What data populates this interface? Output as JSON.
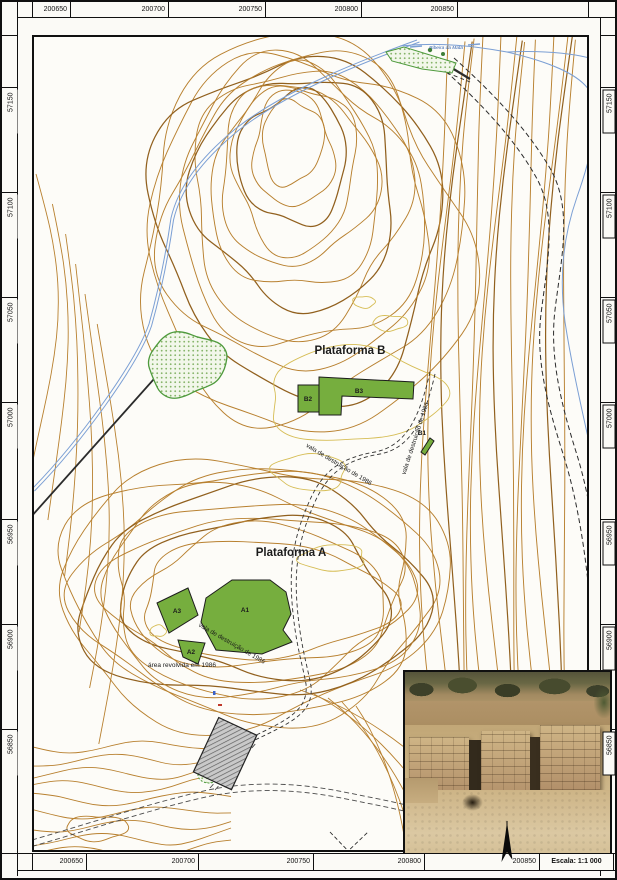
{
  "sheet": {
    "top_coords": [
      "200650",
      "200700",
      "200750",
      "200800",
      "200850"
    ],
    "bottom_coords": [
      "200650",
      "200700",
      "200750",
      "200800",
      "200850"
    ],
    "left_coords": [
      "57150",
      "57100",
      "57050",
      "57000",
      "56950",
      "56900",
      "56850"
    ],
    "right_coords": [
      "57150",
      "57100",
      "57050",
      "57000",
      "56950",
      "56900",
      "56850"
    ],
    "scale_label": "Escala: 1:1 000"
  },
  "map": {
    "platform_b_label": "Plataforma B",
    "platform_a_label": "Plataforma A",
    "areas": {
      "a1": "A1",
      "a2": "A2",
      "a3": "A3",
      "b1": "B1",
      "b2": "B2",
      "b3": "B3"
    },
    "annotations": {
      "trench_platform_b": "vala de destruição de 1986",
      "trench_saddle": "vala de destruição de 1986",
      "trench_platform_a": "vala de destruição de 1986",
      "disturbed_area": "área revolvida em 1986",
      "stream_name": "Ribeira da Mata"
    },
    "colors": {
      "contour_brown": "#b8802f",
      "contour_index": "#91601e",
      "contour_yellow": "#d6bd55",
      "excavation_green": "#76ae3e",
      "stream_blue": "#7b9fd4",
      "vegetation_green": "#4e9a3c"
    }
  }
}
